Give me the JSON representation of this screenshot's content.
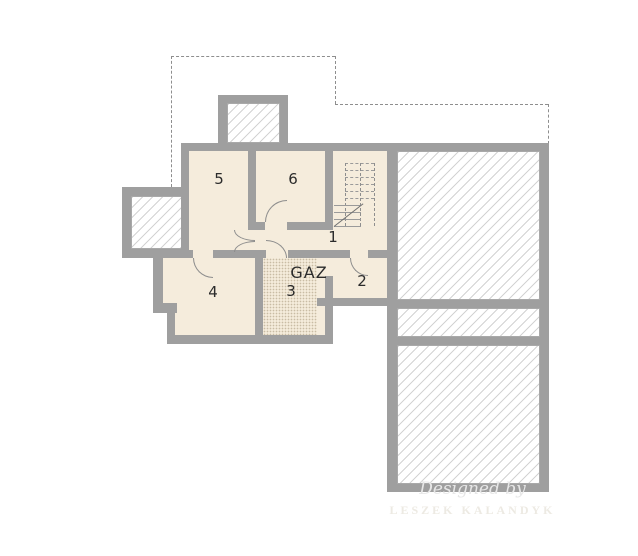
{
  "plan": {
    "type": "basement-floor-plan",
    "rooms": {
      "r1": "1",
      "r2": "2",
      "r3": "3",
      "r4": "4",
      "r5": "5",
      "r6": "6",
      "gaz": "GAZ"
    },
    "watermark": {
      "line1": "Designed by",
      "line2": "LESZEK KALANDYK"
    },
    "colors": {
      "wall": "#9f9f9f",
      "floor": "#f5ecdc",
      "hatch_line": "#6e6e6e",
      "label": "#2b2b2b",
      "watermark": "#e7e7e7"
    }
  }
}
